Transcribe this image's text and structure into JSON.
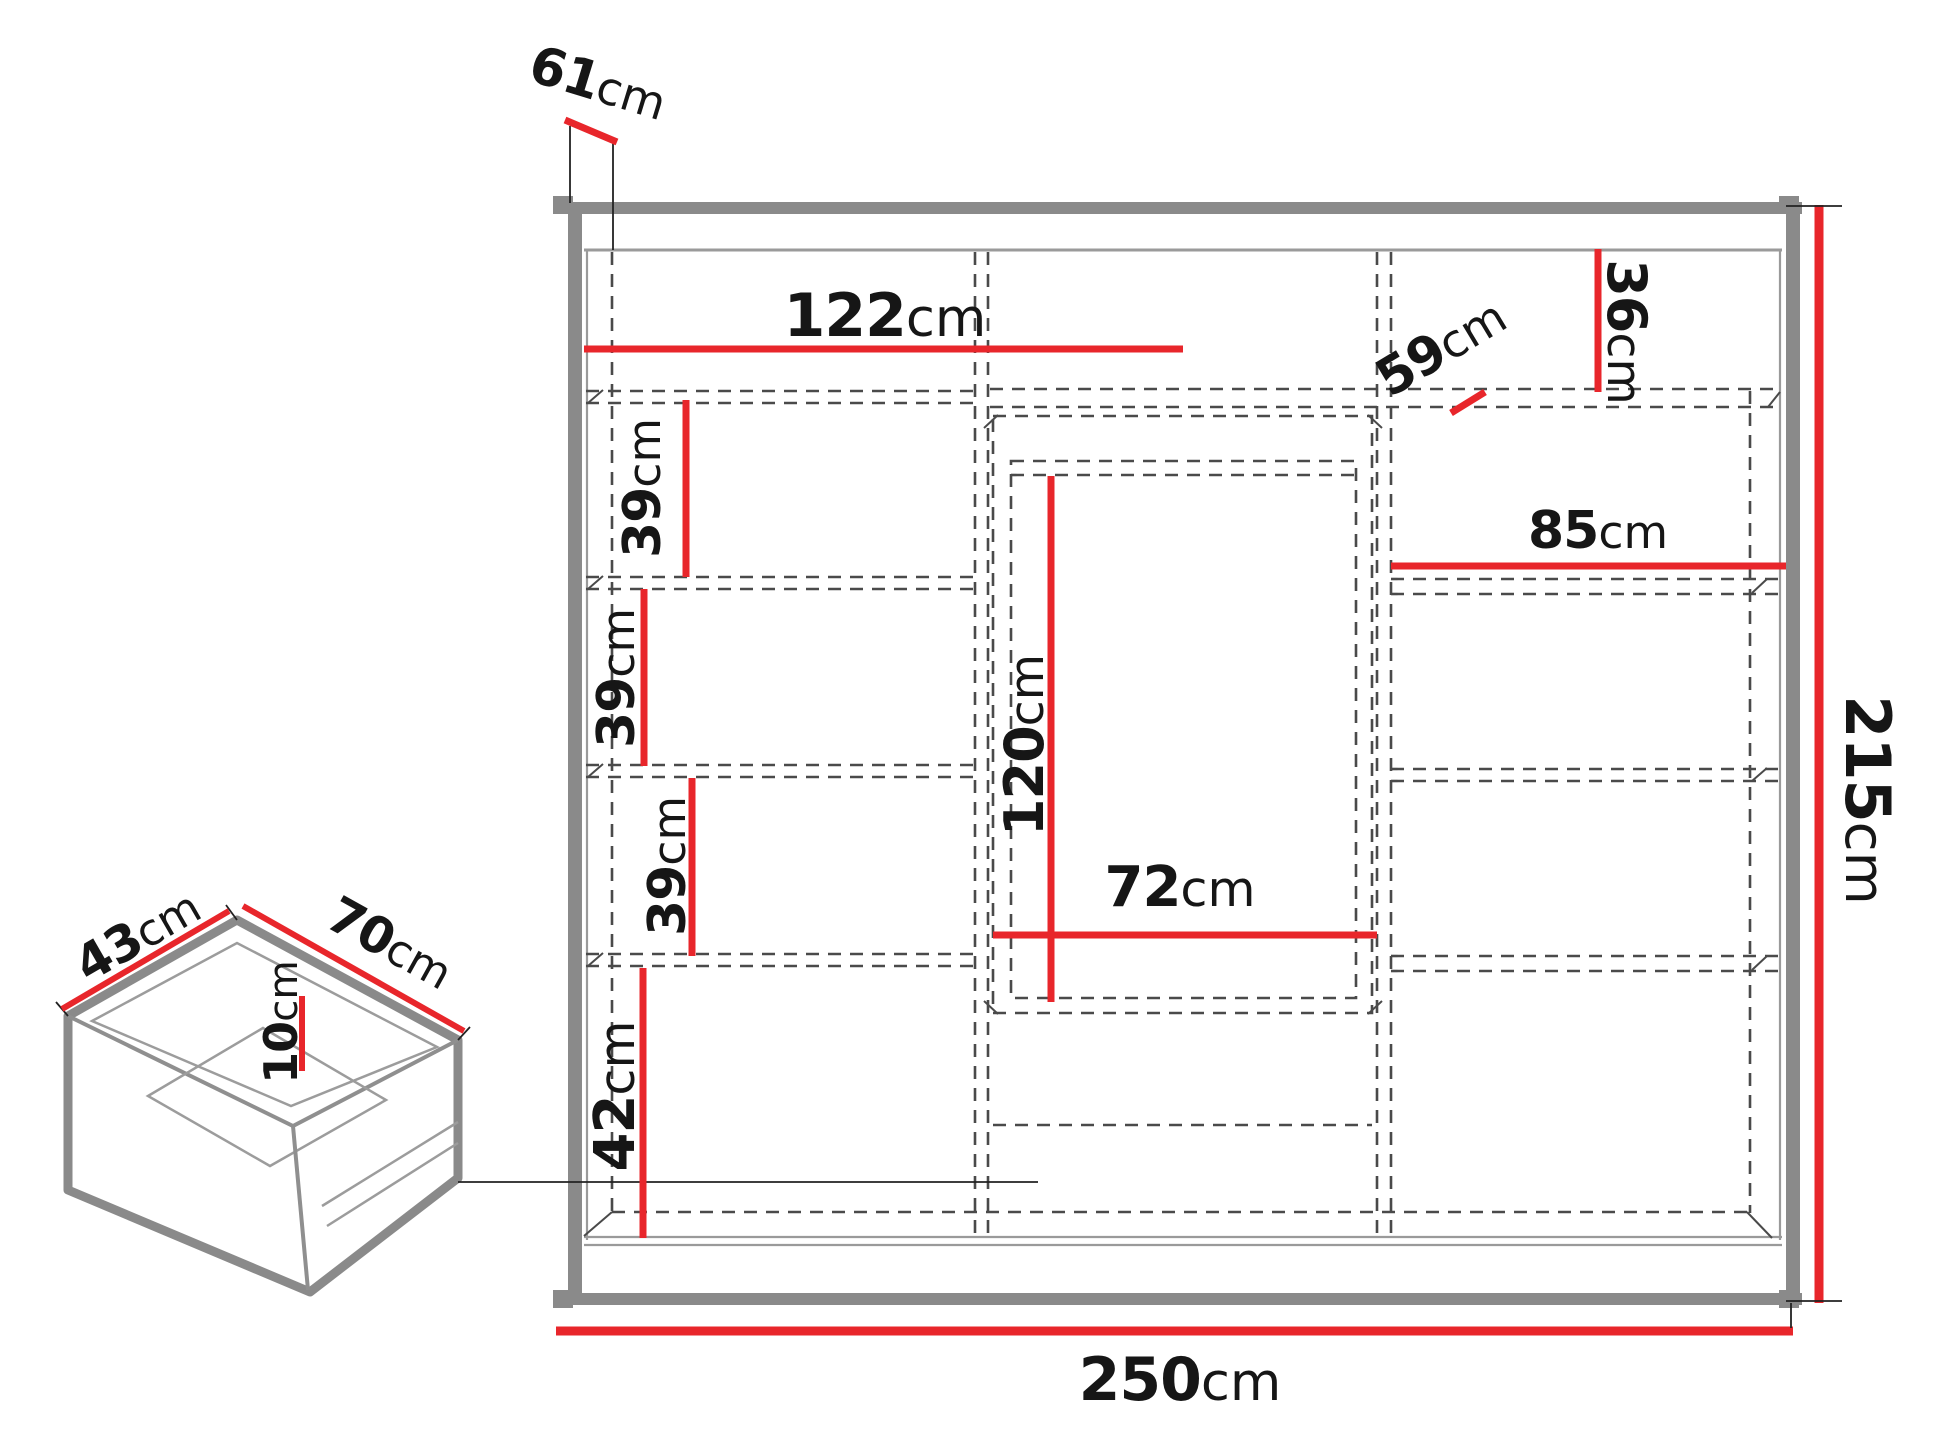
{
  "colors": {
    "dimension_red": "#e8262b",
    "structure_gray": "#8a8a8a",
    "dash_gray": "#4a4a4a",
    "text_black": "#161616"
  },
  "wardrobe": {
    "dims": {
      "top_depth": {
        "value": "61",
        "unit": "cm"
      },
      "left_door_width": {
        "value": "122",
        "unit": "cm"
      },
      "top_shelf_height": {
        "value": "36",
        "unit": "cm"
      },
      "shelf_depth": {
        "value": "59",
        "unit": "cm"
      },
      "shelf_gap_1": {
        "value": "39",
        "unit": "cm"
      },
      "shelf_gap_2": {
        "value": "39",
        "unit": "cm"
      },
      "shelf_gap_3": {
        "value": "39",
        "unit": "cm"
      },
      "bottom_section_height": {
        "value": "42",
        "unit": "cm"
      },
      "mirror_section_height": {
        "value": "120",
        "unit": "cm"
      },
      "mirror_section_width": {
        "value": "72",
        "unit": "cm"
      },
      "right_section_width": {
        "value": "85",
        "unit": "cm"
      },
      "total_width": {
        "value": "250",
        "unit": "cm"
      },
      "total_height": {
        "value": "215",
        "unit": "cm"
      }
    }
  },
  "drawer": {
    "dims": {
      "side_depth": {
        "value": "43",
        "unit": "cm"
      },
      "front_width": {
        "value": "70",
        "unit": "cm"
      },
      "inner_height": {
        "value": "10",
        "unit": "cm"
      }
    }
  }
}
